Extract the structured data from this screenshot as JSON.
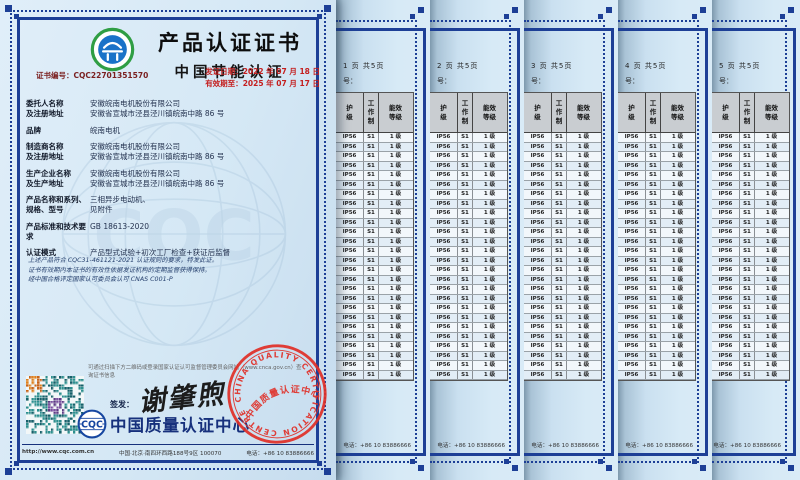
{
  "certificate": {
    "title": "产品认证证书",
    "subtitle": "中国节能认证",
    "cert_no_label": "证书编号：",
    "cert_no": "CQC22701351570",
    "issue_date_label": "发证日期：",
    "issue_date": "2022 年 07 月 18 日",
    "valid_until_label": "有效期至：",
    "valid_until": "2025 年 07 月 17 日",
    "fields": [
      {
        "labels": [
          "委托人名称",
          "及注册地址"
        ],
        "values": [
          "安徽皖南电机股份有限公司",
          "安徽省宣城市泾县泾川镇皖南中路 86 号"
        ]
      },
      {
        "labels": [
          "品牌"
        ],
        "values": [
          "皖南电机"
        ]
      },
      {
        "labels": [
          "制造商名称",
          "及注册地址"
        ],
        "values": [
          "安徽皖南电机股份有限公司",
          "安徽省宣城市泾县泾川镇皖南中路 86 号"
        ]
      },
      {
        "labels": [
          "生产企业名称",
          "及生产地址"
        ],
        "values": [
          "安徽皖南电机股份有限公司",
          "安徽省宣城市泾县泾川镇皖南中路 86 号"
        ]
      },
      {
        "labels": [
          "产品名称和系列、",
          "规格、型号"
        ],
        "values": [
          "三相异步电动机、",
          "见附件"
        ]
      },
      {
        "labels": [
          "产品标准和技术要求"
        ],
        "values": [
          "GB 18613-2020"
        ]
      },
      {
        "labels": [
          "认证模式"
        ],
        "values": [
          "产品型式试验+初次工厂检查+获证后监督"
        ]
      }
    ],
    "statement_lines": [
      "上述产品符合 CQC31-461121-2021 认证规则的要求，特发此证。",
      "证书有效期内本证书的有效性依据发证机构的定期监督获得保持。",
      "经中国合格评定国家认可委员会认可 CNAS C001-P"
    ],
    "qr_hint": "可通过扫描下方二维码或登录国家认证认可监督管理委员会网站（www.cnca.gov.cn）查询证书信息",
    "sign_label": "签发：",
    "signature": "谢肇煦",
    "issuer": "中国质量认证中心",
    "issuer_logo_text": "CQC",
    "stamp_ring_text": "CHINA QUALITY CERTIFICATION CENTRE",
    "stamp_inner_text": "中国质量认证中心",
    "watermark_text": "CQC",
    "footer": {
      "url": "http://www.cqc.com.cn",
      "address": "中国·北京·南四环西路188号9区  100070",
      "phone": "电话：+86 10 83886666"
    }
  },
  "attachment": {
    "pages": [
      {
        "page_label": "1 页 共5页"
      },
      {
        "page_label": "2 页 共5页"
      },
      {
        "page_label": "3 页 共5页"
      },
      {
        "page_label": "4 页 共5页"
      },
      {
        "page_label": "5 页 共5页"
      }
    ],
    "no_label": "号：",
    "table": {
      "header_columns": [
        [
          "护",
          "级"
        ],
        [
          "工",
          "作",
          "制"
        ],
        [
          "能效",
          "等级"
        ]
      ],
      "row_values": [
        "IP56",
        "S1",
        "1 级"
      ],
      "rows_per_page": 26
    },
    "footer_phone": "电话：+86 10 83886666"
  },
  "colors": {
    "border_navy": "#1d3f96",
    "date_red": "#c41e1e",
    "cert_no_maroon": "#7a1f1f",
    "stamp_red": "#e03028",
    "table_header_bg": "#c9cdd1",
    "issuer_navy": "#16307c",
    "logo_green": "#2f9e44",
    "logo_blue": "#1a72c8"
  }
}
